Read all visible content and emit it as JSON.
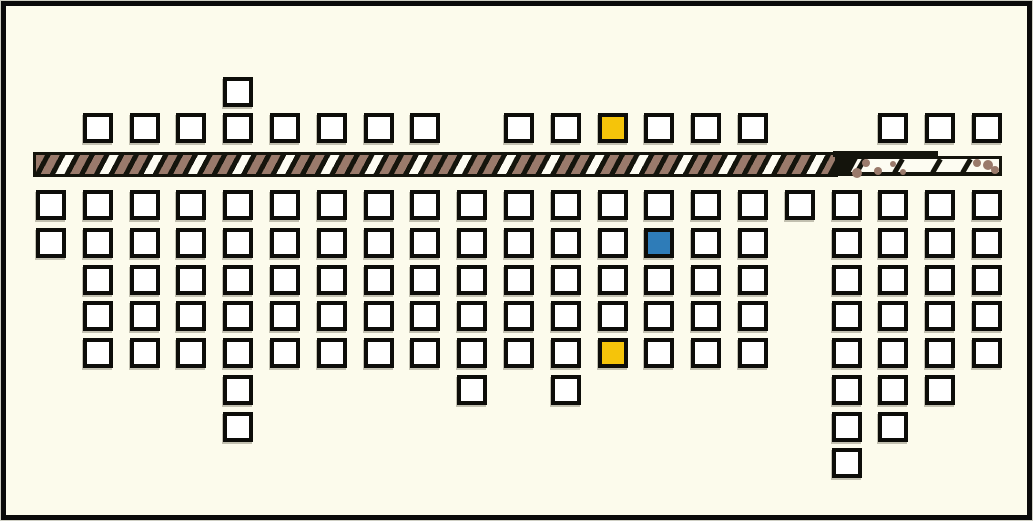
{
  "title": "street-map-diagram",
  "colors": {
    "background": "#fcfbec",
    "frame": "#0a0a0a",
    "square_fill": "#ffffff",
    "square_border": "#0d0d09",
    "highlight_yellow": "#f5c40a",
    "highlight_blue": "#2e7cb8",
    "road_black": "#14140c",
    "road_brown": "#9a7a6b",
    "road_white": "#fdfcf2"
  },
  "grid": {
    "origin_x": 36,
    "col_spacing": 46.8,
    "square_size": 30,
    "rows": [
      {
        "name": "detached-top",
        "y": 77,
        "cols": [
          4
        ]
      },
      {
        "name": "above-road",
        "y": 113,
        "cols": [
          1,
          2,
          3,
          4,
          5,
          6,
          7,
          8,
          10,
          11,
          12,
          13,
          14,
          15,
          18,
          19,
          20
        ]
      },
      {
        "name": "row-1",
        "y": 190,
        "cols": [
          0,
          1,
          2,
          3,
          4,
          5,
          6,
          7,
          8,
          9,
          10,
          11,
          12,
          13,
          14,
          15,
          16,
          17,
          18,
          19,
          20
        ]
      },
      {
        "name": "row-2",
        "y": 228,
        "cols": [
          0,
          1,
          2,
          3,
          4,
          5,
          6,
          7,
          8,
          9,
          10,
          11,
          12,
          13,
          14,
          15,
          17,
          18,
          19,
          20
        ]
      },
      {
        "name": "row-3",
        "y": 265,
        "cols": [
          1,
          2,
          3,
          4,
          5,
          6,
          7,
          8,
          9,
          10,
          11,
          12,
          13,
          14,
          15,
          17,
          18,
          19,
          20
        ]
      },
      {
        "name": "row-4",
        "y": 301,
        "cols": [
          1,
          2,
          3,
          4,
          5,
          6,
          7,
          8,
          9,
          10,
          11,
          12,
          13,
          14,
          15,
          17,
          18,
          19,
          20
        ]
      },
      {
        "name": "row-5",
        "y": 338,
        "cols": [
          1,
          2,
          3,
          4,
          5,
          6,
          7,
          8,
          9,
          10,
          11,
          12,
          13,
          14,
          15,
          17,
          18,
          19,
          20
        ]
      },
      {
        "name": "row-6",
        "y": 375,
        "cols": [
          4,
          9,
          11,
          17,
          18,
          19
        ]
      },
      {
        "name": "row-7",
        "y": 412,
        "cols": [
          4,
          17,
          18
        ]
      },
      {
        "name": "row-8",
        "y": 448,
        "cols": [
          17
        ]
      }
    ]
  },
  "highlights": [
    {
      "row": "above-road",
      "col": 12,
      "color": "yellow"
    },
    {
      "row": "row-2",
      "col": 13,
      "color": "blue"
    },
    {
      "row": "row-5",
      "col": 12,
      "color": "yellow"
    }
  ],
  "road": {
    "x": 33,
    "y": 152,
    "height": 25,
    "hatched_width": 805,
    "plain": {
      "x": 838,
      "width": 164,
      "y": 156,
      "height": 20,
      "dashes_x": [
        20,
        58,
        96,
        126
      ],
      "dots": [
        {
          "x": 5,
          "y": 1,
          "r": 4
        },
        {
          "x": 14,
          "y": 9,
          "r": 5
        },
        {
          "x": 24,
          "y": 0,
          "r": 4
        },
        {
          "x": 36,
          "y": 8,
          "r": 4
        },
        {
          "x": 52,
          "y": 2,
          "r": 3
        },
        {
          "x": 62,
          "y": 10,
          "r": 3
        },
        {
          "x": 135,
          "y": 0,
          "r": 4
        },
        {
          "x": 145,
          "y": 1,
          "r": 5
        },
        {
          "x": 153,
          "y": 7,
          "r": 4
        }
      ]
    },
    "lip": {
      "x": 833,
      "y": 151,
      "width": 105,
      "height": 6
    },
    "junction": {
      "x": 833,
      "y": 152,
      "width": 22,
      "height": 24
    }
  }
}
